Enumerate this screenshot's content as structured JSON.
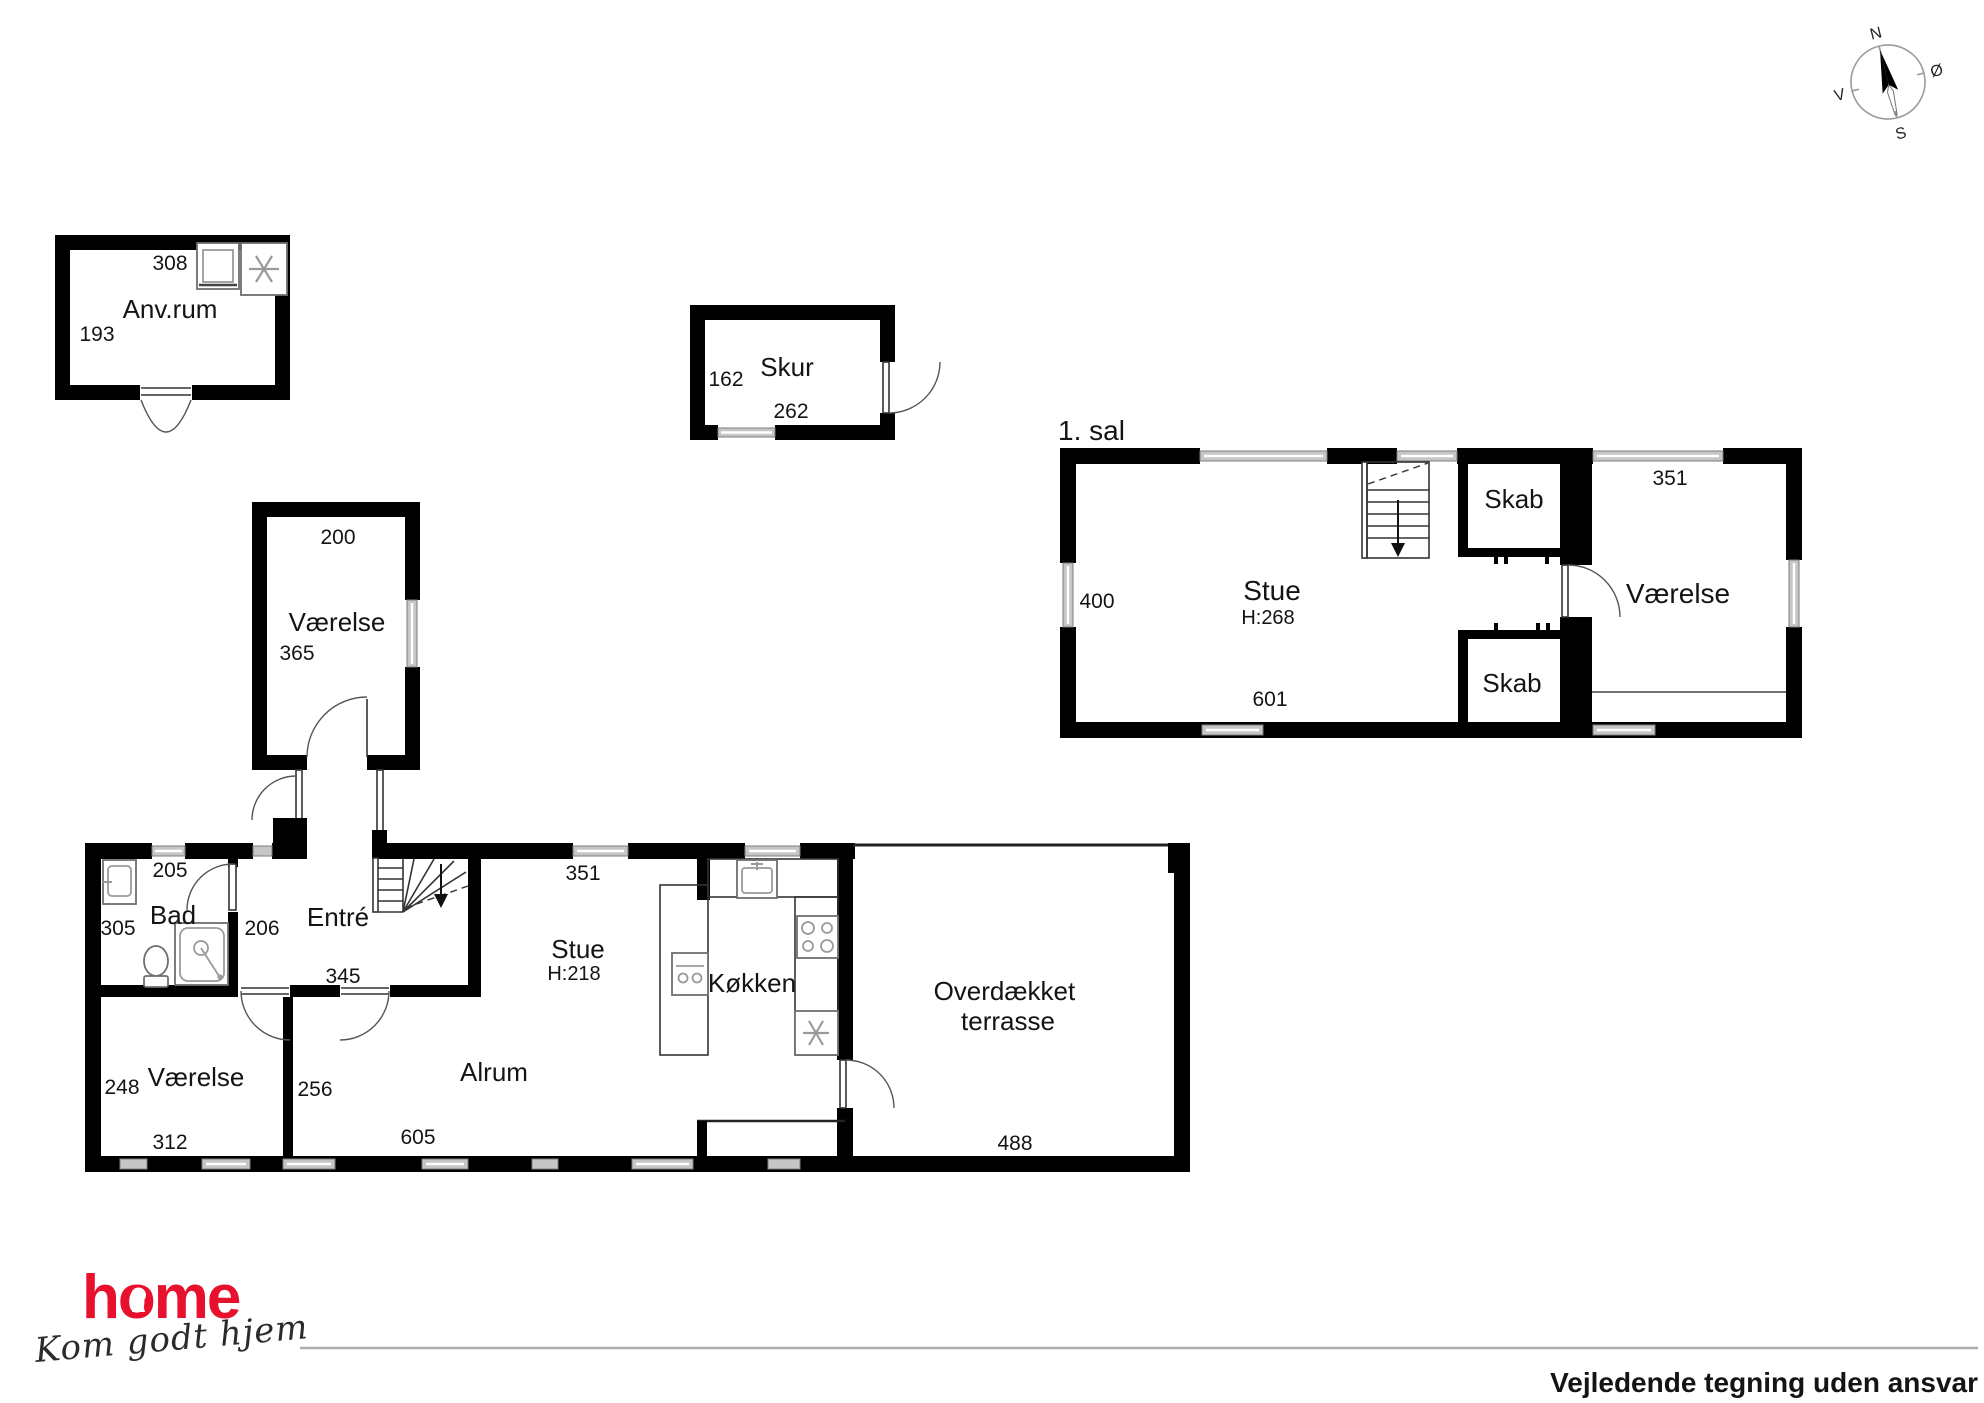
{
  "footer": {
    "disclaimer": "Vejledende tegning uden ansvar"
  },
  "logo": {
    "brand": "home",
    "tagline": "Kom godt hjem",
    "color": "#e8112d"
  },
  "compass": {
    "north": "N",
    "east": "Ø",
    "south": "S",
    "west": "V"
  },
  "outbuilding_anvrum": {
    "room": "Anv.rum",
    "dim_width": "308",
    "dim_depth": "193"
  },
  "outbuilding_skur": {
    "room": "Skur",
    "dim_depth": "162",
    "dim_width": "262"
  },
  "annex": {
    "room": "Værelse",
    "dim_width": "200",
    "dim_depth": "365"
  },
  "first_floor": {
    "title": "1. sal",
    "stue": "Stue",
    "stue_height": "H:268",
    "skab_upper": "Skab",
    "skab_lower": "Skab",
    "vaerelse": "Værelse",
    "dim_left": "400",
    "dim_bottom": "601",
    "dim_top_right": "351"
  },
  "ground_floor": {
    "bad": "Bad",
    "entre": "Entré",
    "stue": "Stue",
    "stue_height": "H:218",
    "koekken": "Køkken",
    "vaerelse": "Værelse",
    "alrum": "Alrum",
    "terrasse_line1": "Overdækket",
    "terrasse_line2": "terrasse",
    "dims": {
      "d205": "205",
      "d305": "305",
      "d206": "206",
      "d345": "345",
      "d351": "351",
      "d248": "248",
      "d256": "256",
      "d312": "312",
      "d605": "605",
      "d488": "488"
    }
  }
}
